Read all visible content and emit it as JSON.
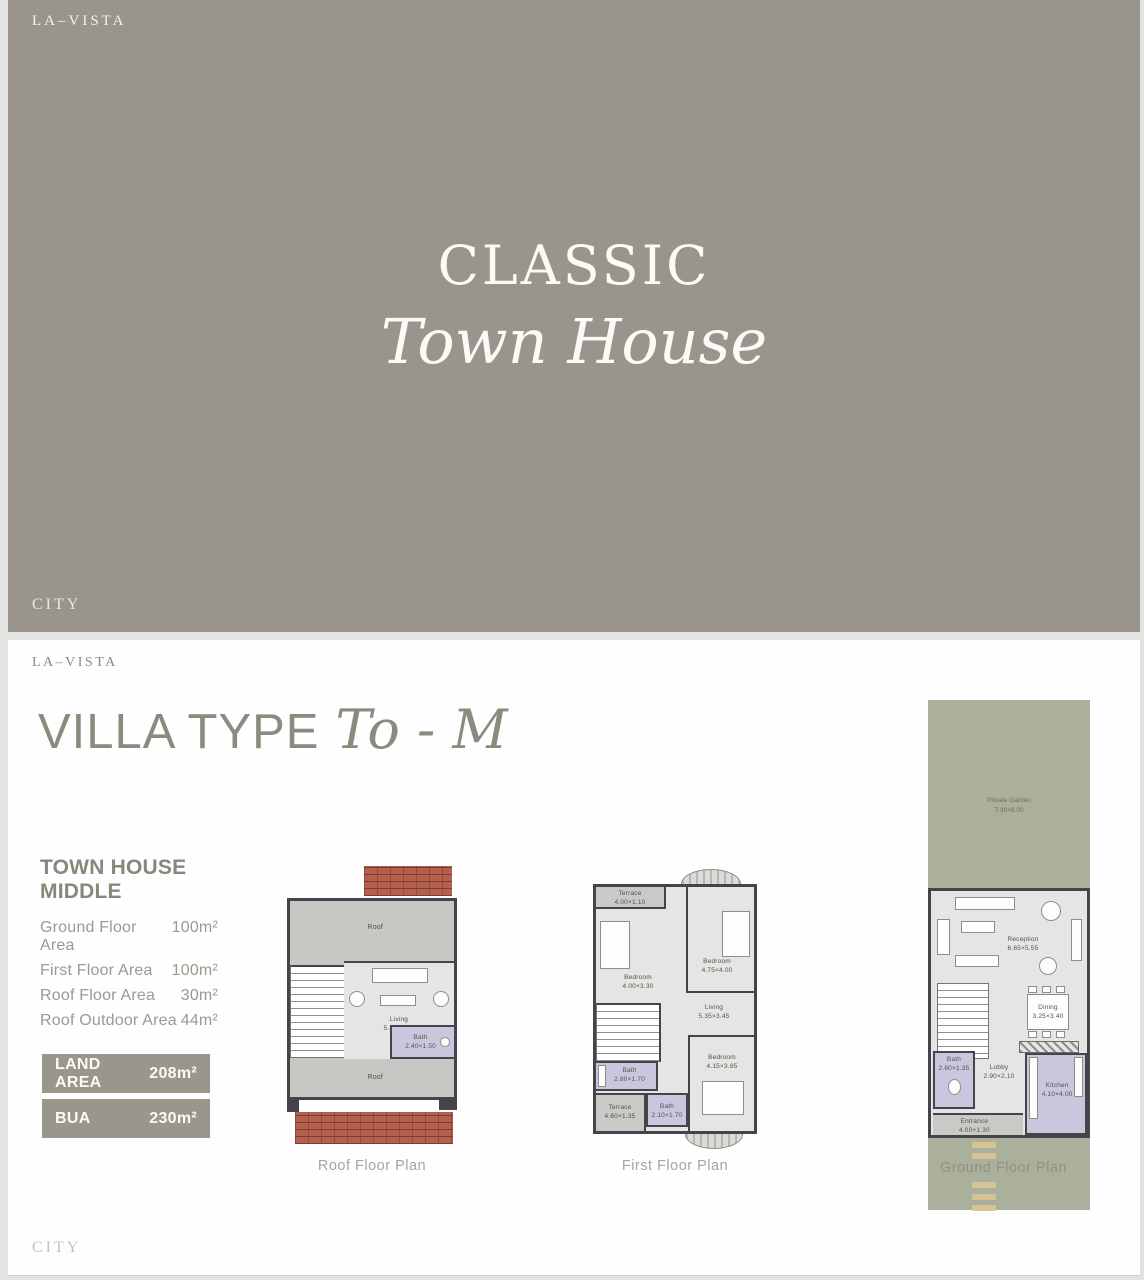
{
  "colors": {
    "banner_taupe": "#99958d",
    "page_bg": "#fefefe",
    "heading_gray": "#8d897f",
    "spec_text_gray": "#9d998f",
    "badge_bg": "#9a968c",
    "badge_text": "#fbfaf7",
    "plan_wall_dark": "#45444a",
    "plan_roof_gray": "#c9c7c4",
    "plan_floor_gray": "#e6e5e3",
    "plan_bath_lavender": "#c9c7dd",
    "plan_brick_red": "#b4604e",
    "plan_garden_green": "#aab09b",
    "driveway_dash_tan": "#d6c494",
    "caption_gray": "#a8a49e"
  },
  "slide1": {
    "brand_top": "LA–VISTA",
    "title_line1": "CLASSIC",
    "title_line2": "Town House",
    "brand_bottom": "CITY"
  },
  "slide2": {
    "brand_top": "LA–VISTA",
    "brand_bottom": "CITY",
    "heading": {
      "main": "VILLA TYPE",
      "script": "To - M"
    },
    "specs": {
      "title": "TOWN HOUSE MIDDLE",
      "rows": [
        {
          "label": "Ground Floor Area",
          "value": "100m²"
        },
        {
          "label": "First Floor Area",
          "value": "100m²"
        },
        {
          "label": "Roof Floor Area",
          "value": "30m²"
        },
        {
          "label": "Roof Outdoor Area",
          "value": "44m²"
        }
      ]
    },
    "badges": [
      {
        "label": "LAND AREA",
        "value": "208m²"
      },
      {
        "label": "BUA",
        "value": "230m²"
      }
    ],
    "plans": {
      "roof": {
        "caption": "Roof Floor Plan",
        "roof_top": "Roof",
        "roof_bottom": "Roof",
        "living": {
          "name": "Living",
          "dims": "5.35×3.30"
        },
        "bath": {
          "name": "Bath",
          "dims": "2.40×1.50"
        }
      },
      "first": {
        "caption": "First Floor Plan",
        "terrace_top": {
          "name": "Terrace",
          "dims": "4.00×1.10"
        },
        "bedroom_left": {
          "name": "Bedroom",
          "dims": "4.00×3.30"
        },
        "bedroom_right": {
          "name": "Bedroom",
          "dims": "4.75×4.00"
        },
        "living": {
          "name": "Living",
          "dims": "5.35×3.45"
        },
        "bath_left": {
          "name": "Bath",
          "dims": "2.80×1.70"
        },
        "bath_mid": {
          "name": "Bath",
          "dims": "2.10×1.70"
        },
        "bedroom_bottom": {
          "name": "Bedroom",
          "dims": "4.15×3.85"
        },
        "terrace_bottom": {
          "name": "Terrace",
          "dims": "4.60×1.35"
        }
      },
      "ground": {
        "caption": "Ground Floor Plan",
        "garden": {
          "name": "Private Garden",
          "dims": "7.30×8.00"
        },
        "reception": {
          "name": "Reception",
          "dims": "6.65×5.55"
        },
        "dining": {
          "name": "Dining",
          "dims": "3.25×3.40"
        },
        "bath": {
          "name": "Bath",
          "dims": "2.60×1.35"
        },
        "lobby": {
          "name": "Lobby",
          "dims": "2.90×2.10"
        },
        "kitchen": {
          "name": "Kitchen",
          "dims": "4.10×4.00"
        },
        "entrance": {
          "name": "Entrance",
          "dims": "4.00×1.30"
        }
      }
    }
  }
}
